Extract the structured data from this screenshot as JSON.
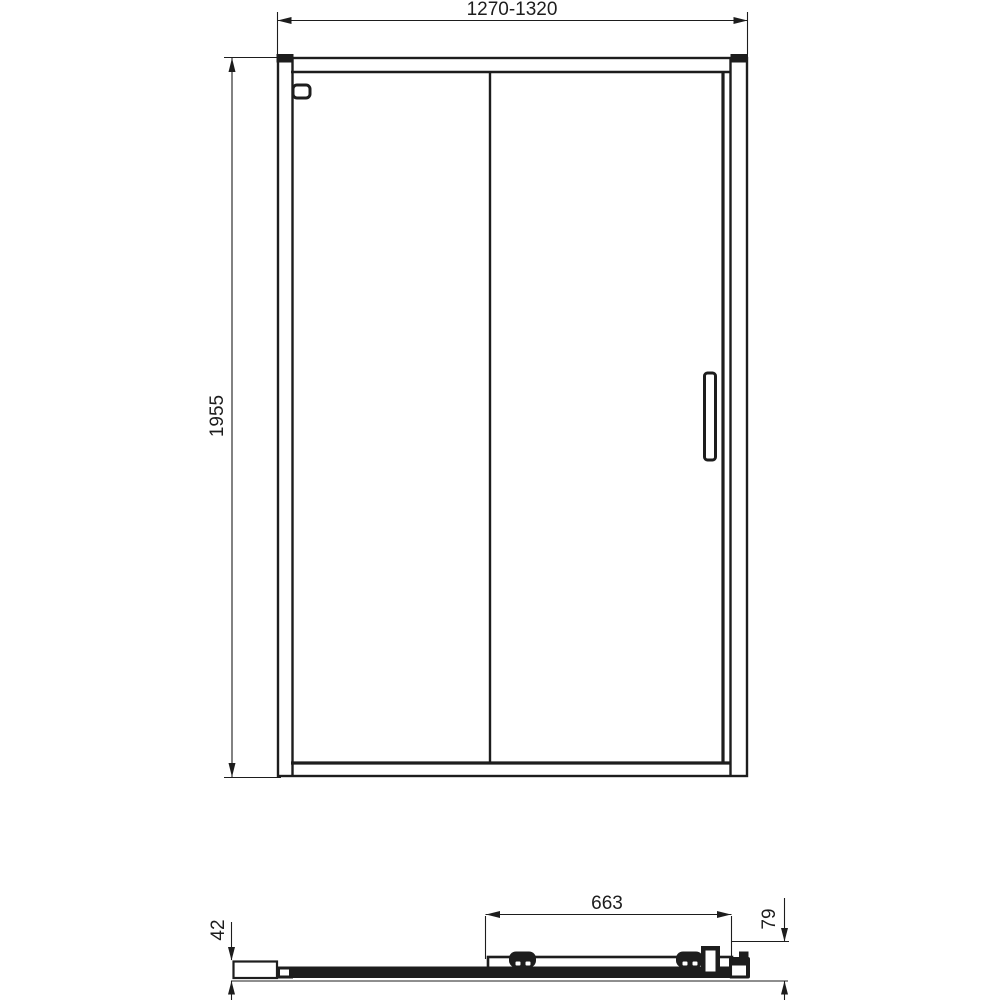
{
  "drawing": {
    "type": "technical-dimension-drawing",
    "subject": "sliding shower door enclosure, front elevation and bottom section view",
    "colors": {
      "line": "#1d1d1d",
      "background": "#ffffff"
    },
    "views": {
      "front_view": {
        "description": "front elevation of two-panel sliding door with frame, handle and top corner brackets"
      },
      "plan_view": {
        "description": "horizontal cross-section showing wall profile, fixed glass, sliding panel, rollers, handle and end knob"
      }
    },
    "dimensions": {
      "overall_width": "1270-1320",
      "overall_height": "1955",
      "sliding_panel_width": "663",
      "wall_profile_depth": "42",
      "total_depth": "79"
    }
  }
}
